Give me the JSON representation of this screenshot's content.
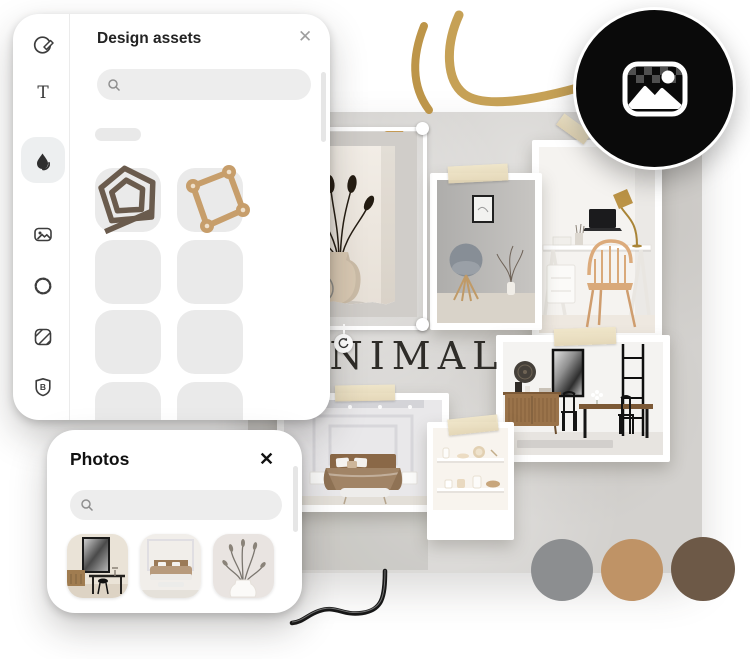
{
  "assets_panel": {
    "title": "Design assets",
    "close_glyph": "✕",
    "search_placeholder": "",
    "sidebar_items": [
      {
        "name": "templates"
      },
      {
        "name": "text"
      },
      {
        "name": "shapes",
        "selected": true
      },
      {
        "name": "media"
      },
      {
        "name": "elements"
      },
      {
        "name": "backgrounds"
      },
      {
        "name": "brand"
      }
    ]
  },
  "photos_panel": {
    "title": "Photos",
    "close_glyph": "✕",
    "search_placeholder": ""
  },
  "canvas": {
    "headline": "MINIMAL"
  },
  "palette": [
    {
      "name": "gray",
      "hex": "#8c8e90"
    },
    {
      "name": "tan",
      "hex": "#bf9366"
    },
    {
      "name": "brown",
      "hex": "#6d5947"
    }
  ],
  "colors": {
    "gold": "#c6a156",
    "canvas_bg": "#d3d1ce",
    "badge_bg": "#0a0a0a",
    "asset_brown": "#6a5b4d",
    "asset_tan": "#c79e6b"
  }
}
